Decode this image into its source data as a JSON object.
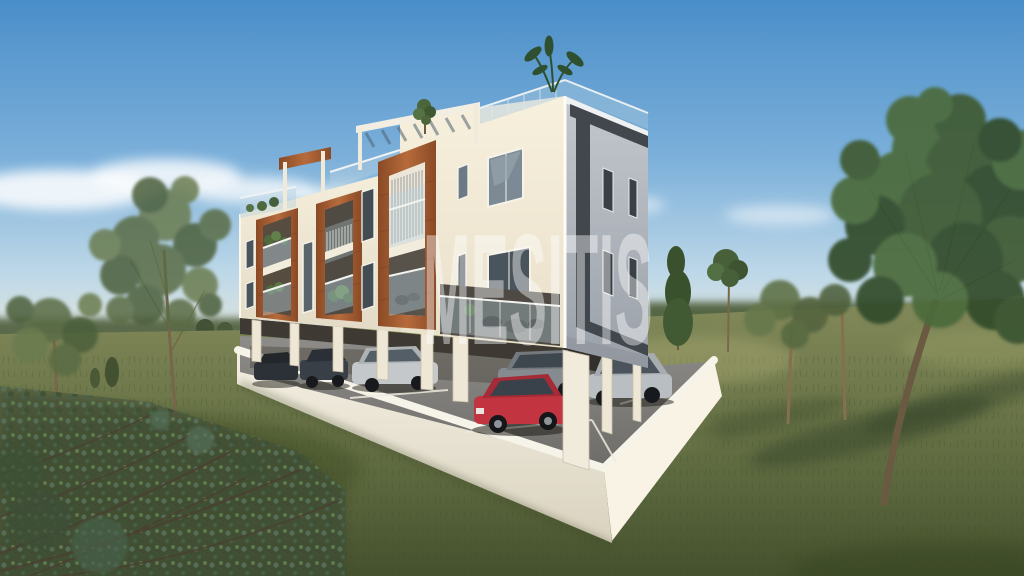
{
  "watermark": {
    "text": "MESITIS",
    "color": "#ffffff",
    "opacity": 0.42
  },
  "scene": {
    "description": "3D exterior render of a modern three-storey apartment building with rooftop terrace, wood-clad balcony frames and open ground-floor parking on a white podium, set in a grassy field with trees",
    "sky": {
      "top": "#4a8ec9",
      "horizon": "#e8e8da",
      "cloud_color": "#ffffff"
    },
    "grass": {
      "lit": "#83895a",
      "shadow": "#45512d"
    },
    "building": {
      "storeys": 3,
      "facade_front_color": "#f2ebd8",
      "facade_side_color": "#b0b6bd",
      "dark_trim_color": "#42474e",
      "wood_accent_color": "#a85c33",
      "features": [
        "rooftop glass railing",
        "white pergola",
        "wood-framed balconies",
        "spiral stair screen",
        "open pilotis parking"
      ]
    },
    "podium": {
      "wall_color": "#f2ede0",
      "asphalt_color": "#7c7a76",
      "marking_color": "#eceade"
    },
    "cars": [
      {
        "name": "car-dark-1",
        "color": "#2c3137"
      },
      {
        "name": "car-dark-2",
        "color": "#383f46"
      },
      {
        "name": "car-silver-left",
        "color": "#c4c8ca"
      },
      {
        "name": "car-gray",
        "color": "#868b8f"
      },
      {
        "name": "car-red",
        "color": "#c13440"
      },
      {
        "name": "car-silver-wagon",
        "color": "#b9bec2"
      }
    ],
    "vegetation": {
      "left_trees": 2,
      "right_trees": 5,
      "foreground_bush": true,
      "rooftop_plants": 2
    }
  }
}
